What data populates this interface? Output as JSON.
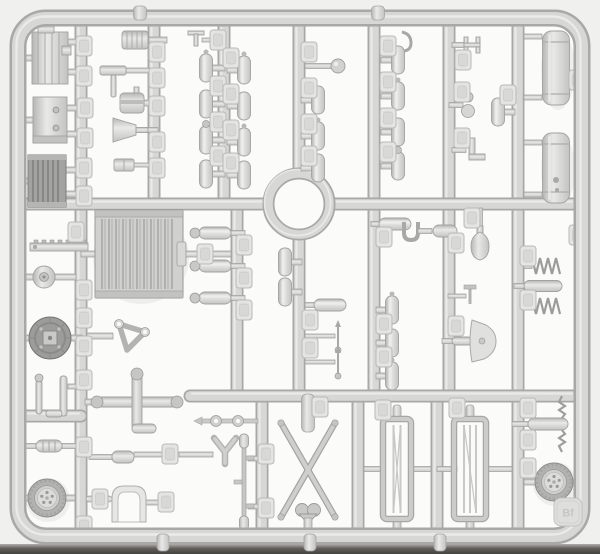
{
  "scene": {
    "description": "Top-down photograph of a light-grey injection-molded plastic model-kit sprue (parts tree) with a rectangular outer frame, a grid of runners, a central alignment ring and dozens of small styrene parts attached by short gates, each with an embossed part-number pad",
    "type": "model-kit-sprue-photo"
  },
  "tag": {
    "label": "Bf"
  },
  "colors": {
    "bg": "#f0f0ee",
    "cell": "#fbfbfa",
    "runner": "#d7d7d6",
    "runner_edge": "#a8a8a7",
    "runner_hi": "#efefee",
    "part": "#d3d3d2",
    "part_dark": "#a3a3a2",
    "part_darker": "#8d8d8c",
    "pad": "#e4e4e3",
    "pad_inner": "#d8d8d7",
    "band_dark": "#45433f",
    "tag_text": "#c4c4c3"
  },
  "parts_inventory": [
    "outer-sprue-frame",
    "runner-grid",
    "central-alignment-ring",
    "engine-block",
    "engine-crankcase",
    "small-ribbed-radiator",
    "large-radiator-core",
    "gear-rack-bar",
    "pulley",
    "axle-final-drive-housing",
    "exhaust-pipes",
    "small-muffler",
    "road-wheel-five-bolt-hub-x2",
    "funnel",
    "piston-cylinder",
    "tool-handles",
    "tow-fork",
    "cross-pipe-manifold",
    "triangular-bracket",
    "arched-fender-section",
    "linkage-rod",
    "scissor-x-frame",
    "stretcher-frame-x2",
    "shovel-blade",
    "grease-pump-body",
    "coil-spring-x2",
    "threaded-screw-rods",
    "fuel-drum-x2",
    "capsule-fittings-many",
    "part-number-pads-many",
    "embossed-sprue-letter-tag"
  ]
}
